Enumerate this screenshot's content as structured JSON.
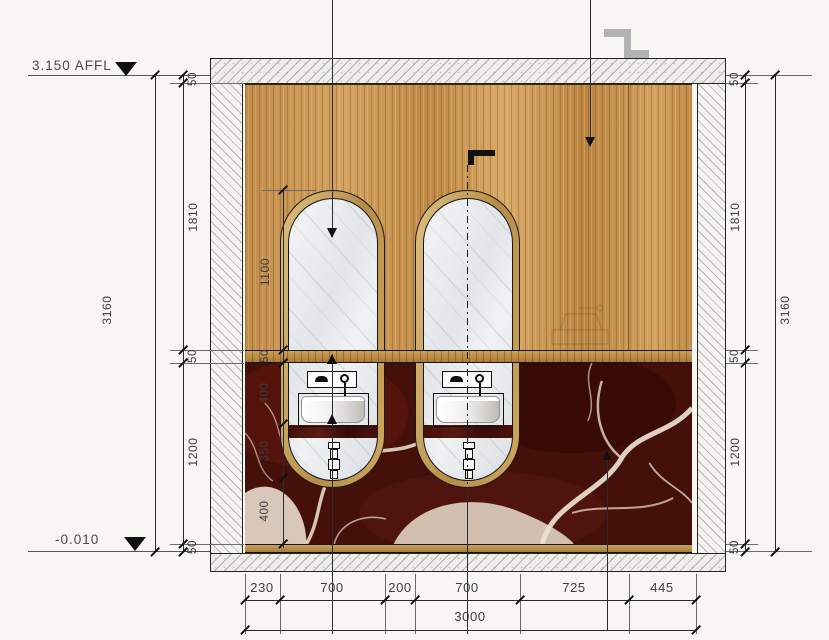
{
  "drawing": {
    "levels": {
      "top": "3.150 AFFL",
      "bottom": "-0.010"
    },
    "dimensions": {
      "left_total": "3160",
      "right_total": "3160",
      "left_chain": [
        "50",
        "1810",
        "50",
        "1200",
        "50"
      ],
      "right_chain": [
        "50",
        "1810",
        "50",
        "1200",
        "50"
      ],
      "fixture_chain": [
        "1100",
        "50",
        "400",
        "350",
        "400"
      ],
      "bottom_chain": [
        "230",
        "700",
        "200",
        "700",
        "725",
        "445"
      ],
      "bottom_total": "3000"
    },
    "materials": {
      "wood_panel": "#c89a55",
      "capsule_frame": "#c8a45f",
      "shelf": "#b8873e",
      "marble_base": "#451009",
      "marble_vein": "#e9ddce",
      "mirror": "#e8ebed",
      "counter": "#3f0d09",
      "hatch_gray": "#9a9a9a",
      "symbol_gray": "#b2b2b2",
      "line": "#1b1b1b"
    }
  }
}
